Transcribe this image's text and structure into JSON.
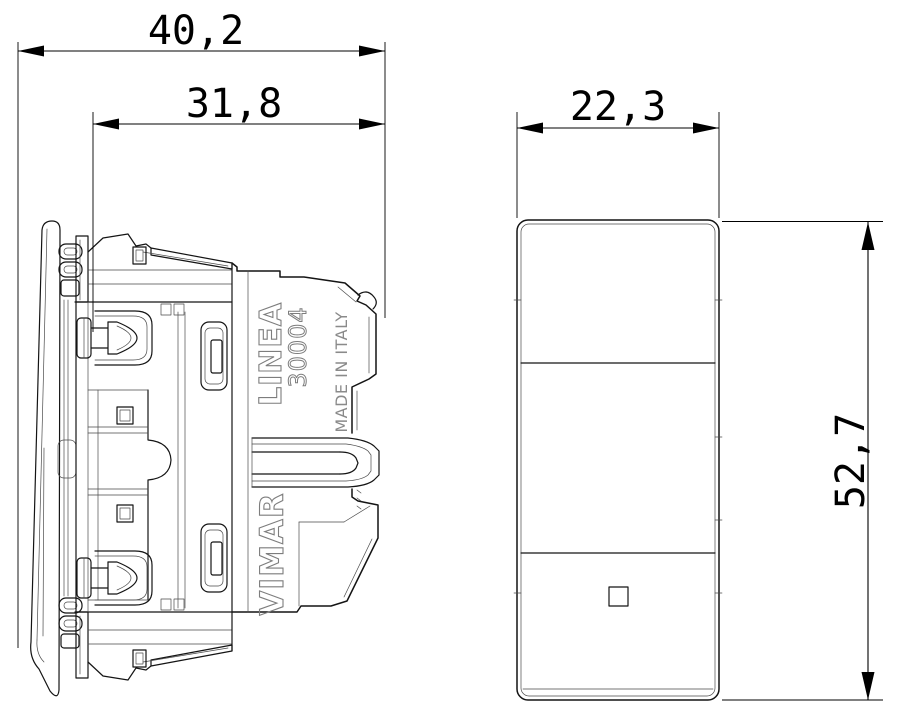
{
  "dimensions": {
    "side_view": {
      "overall_depth_mm": "40,2",
      "body_depth_mm": "31,8"
    },
    "front_view": {
      "width_mm": "22,3",
      "height_mm": "52,7"
    }
  },
  "markings": {
    "series": "LINEA",
    "article": "30004",
    "origin": "MADE IN ITALY",
    "brand": "VIMAR"
  },
  "colors": {
    "line": "#141414",
    "dimension": "#000000",
    "marking": "#7d7d7d",
    "background": "#ffffff"
  }
}
